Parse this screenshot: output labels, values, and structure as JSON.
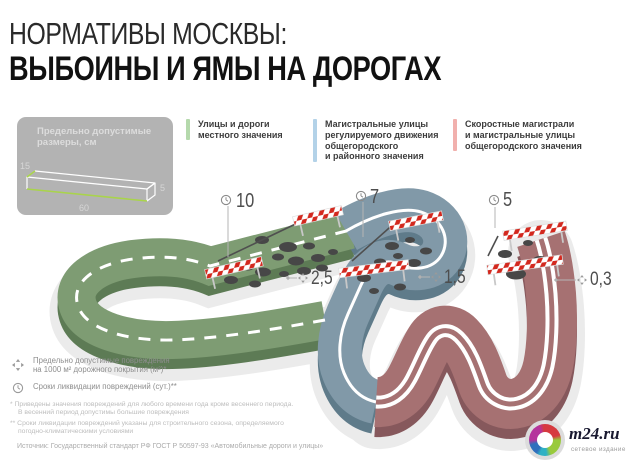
{
  "title": {
    "line1": "НОРМАТИВЫ МОСКВЫ:",
    "line2": "ВЫБОИНЫ И ЯМЫ НА ДОРОГАХ"
  },
  "size_box": {
    "title": "Предельно допустимые\nразмеры, см",
    "width_cm": "15",
    "depth_cm": "5",
    "length_cm": "60"
  },
  "road_legend": [
    {
      "label": "Улицы и дороги\nместного значения",
      "color": "#b5d9ac"
    },
    {
      "label": "Магистральные улицы\nрегулируемого движения\nобщегородского\nи районного значения",
      "color": "#b3d2e8"
    },
    {
      "label": "Скоростные магистрали\nи магистральные улицы\nобщегородского значения",
      "color": "#f1b0ad"
    }
  ],
  "roads": [
    {
      "days": "10",
      "damage_area": "2,5"
    },
    {
      "days": "7",
      "damage_area": "1,5"
    },
    {
      "days": "5",
      "damage_area": "0,3"
    }
  ],
  "metrics_legend": [
    {
      "icon": "area-expand-icon",
      "label": "Предельно допустимые повреждения\nна 1000 м² дорожного покрытия (м²)*"
    },
    {
      "icon": "clock-icon",
      "label": "Сроки ликвидации повреждений (сут.)**"
    }
  ],
  "footnotes": {
    "first": "* Приведены значения повреждений для любого времени года кроме весеннего периода.\nВ весенний период допустимы большие повреждения",
    "second": "** Сроки ликвидации повреждений указаны для строительного сезона, определяемого\nпогодно-климатическими условиями"
  },
  "source": "Источник: Государственный стандарт РФ ГОСТ Р 50597-93 «Автомобильные дороги и улицы»",
  "logo": {
    "title": "m24.ru",
    "subtitle": "сетевое издание",
    "ring_colors": [
      "#d63a3f",
      "#99ca3c",
      "#2fb1c4",
      "#2f6fbd",
      "#b5339c"
    ]
  },
  "colors": {
    "green_top": "#7e9c73",
    "green_side": "#5d7b55",
    "blue_top": "#8199a8",
    "blue_side": "#5f7b8a",
    "red_top": "#a67172",
    "red_side": "#86585c",
    "halo": "#ebebeb",
    "pothole": "#474747",
    "stripe_red": "#d3281e",
    "marking": "#ffffff",
    "box_green": "#a9d44b",
    "box_line": "#ffffff"
  }
}
